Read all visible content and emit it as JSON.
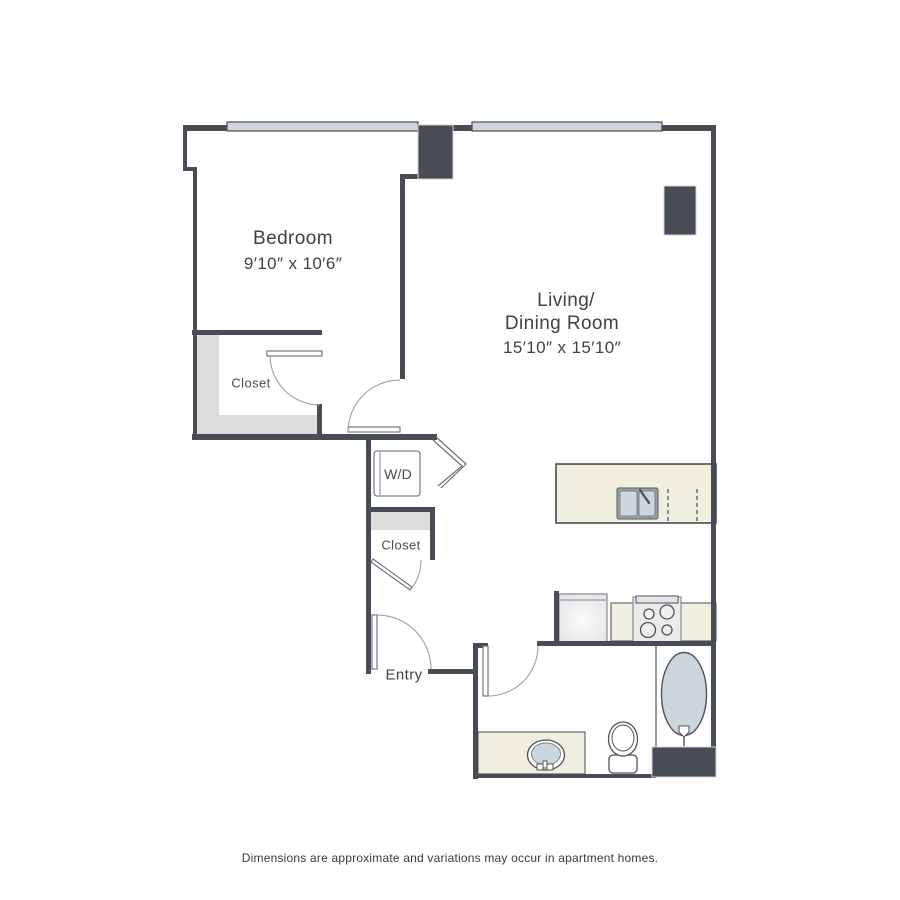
{
  "plan": {
    "bedroom": {
      "label": "Bedroom",
      "dims": "9′10″ x 10′6″"
    },
    "living": {
      "line1": "Living/",
      "line2": "Dining Room",
      "dims": "15′10″ x 15′10″"
    },
    "entry": {
      "label": "Entry"
    },
    "bedroom_closet": {
      "label": "Closet"
    },
    "hall_closet": {
      "label": "Closet"
    },
    "laundry": {
      "label": "W/D"
    }
  },
  "footer": {
    "disclaimer": "Dimensions are approximate and variations may occur in apartment homes."
  },
  "colors": {
    "wall": "#474c55",
    "window_fill": "#cfd4d9",
    "closet_shelf": "#dcdcdc",
    "counter_beige": "#f1efdf",
    "fixture_blue": "#ccd7dd",
    "appliance_gray": "#ebebeb",
    "text": "#424242"
  }
}
